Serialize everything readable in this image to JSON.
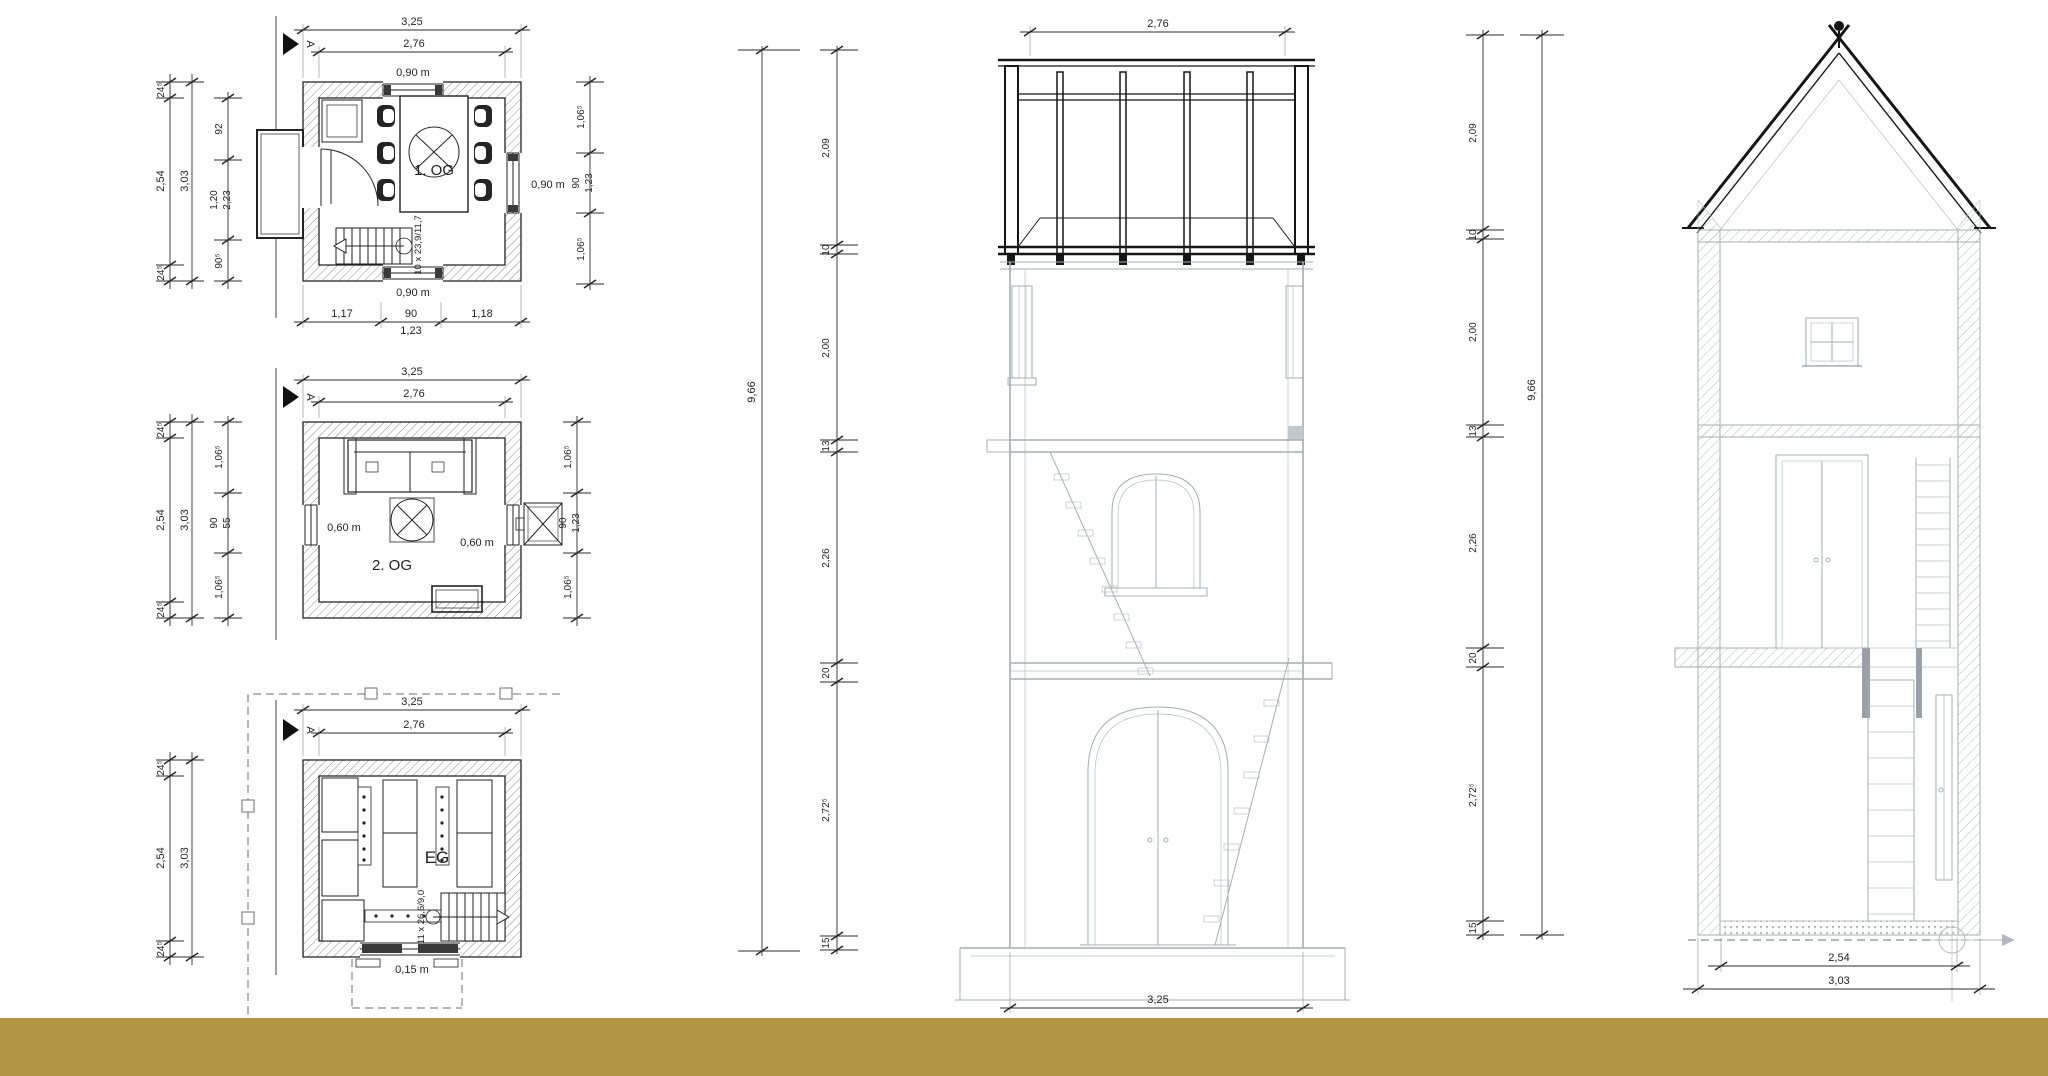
{
  "page": {
    "background_color": "#ffffff",
    "footer_bar_color": "#b19743"
  },
  "plans": [
    {
      "title": "1. OG",
      "section_marker": "A",
      "stair_label": "10 x 23,9/11,7",
      "dims": {
        "top_outer": "3,25",
        "top_inner": "2,76",
        "window_top": "0,90 m",
        "window_right": "0,90 m",
        "window_bottom": "0,90 m",
        "left_outer": [
          "24⁵",
          "2,54",
          "3,03",
          "24⁵"
        ],
        "left_inner": [
          "92",
          "1,20",
          "2,23",
          "90⁵"
        ],
        "right": [
          "1,06⁵",
          "90",
          "1,23",
          "1,06⁵"
        ],
        "bottom": [
          "1,17",
          "90",
          "1,23",
          "1,18"
        ]
      }
    },
    {
      "title": "2. OG",
      "section_marker": "A",
      "dims": {
        "top_outer": "3,25",
        "top_inner": "2,76",
        "window_left": "0,60 m",
        "window_right": "0,60 m",
        "left_outer": [
          "24⁵",
          "2,54",
          "3,03",
          "24⁵"
        ],
        "left_inner": [
          "1,06⁵",
          "90",
          "55",
          "1,06⁵"
        ],
        "right": [
          "1,06⁵",
          "90",
          "1,23",
          "1,06⁵"
        ]
      }
    },
    {
      "title": "EG",
      "section_marker": "A",
      "stair_label": "11 x 26,6/9,0",
      "dims": {
        "top_outer": "3,25",
        "top_inner": "2,76",
        "left_outer": [
          "24⁵",
          "2,54",
          "3,03",
          "24⁵"
        ],
        "bottom_note": "0,15 m"
      }
    }
  ],
  "sections": [
    {
      "top_width": "2,76",
      "bottom_width": "3,25",
      "total_height": "9,66",
      "height_chain": [
        "2,09",
        "10",
        "2,00",
        "13",
        "2,26",
        "20",
        "2,72⁵",
        "15"
      ]
    },
    {
      "total_height": "9,66",
      "bottom_inner": "2,54",
      "bottom_outer": "3,03",
      "height_chain": [
        "2,09",
        "10",
        "2,00",
        "13",
        "2,26",
        "20",
        "2,72⁵",
        "15"
      ]
    }
  ]
}
